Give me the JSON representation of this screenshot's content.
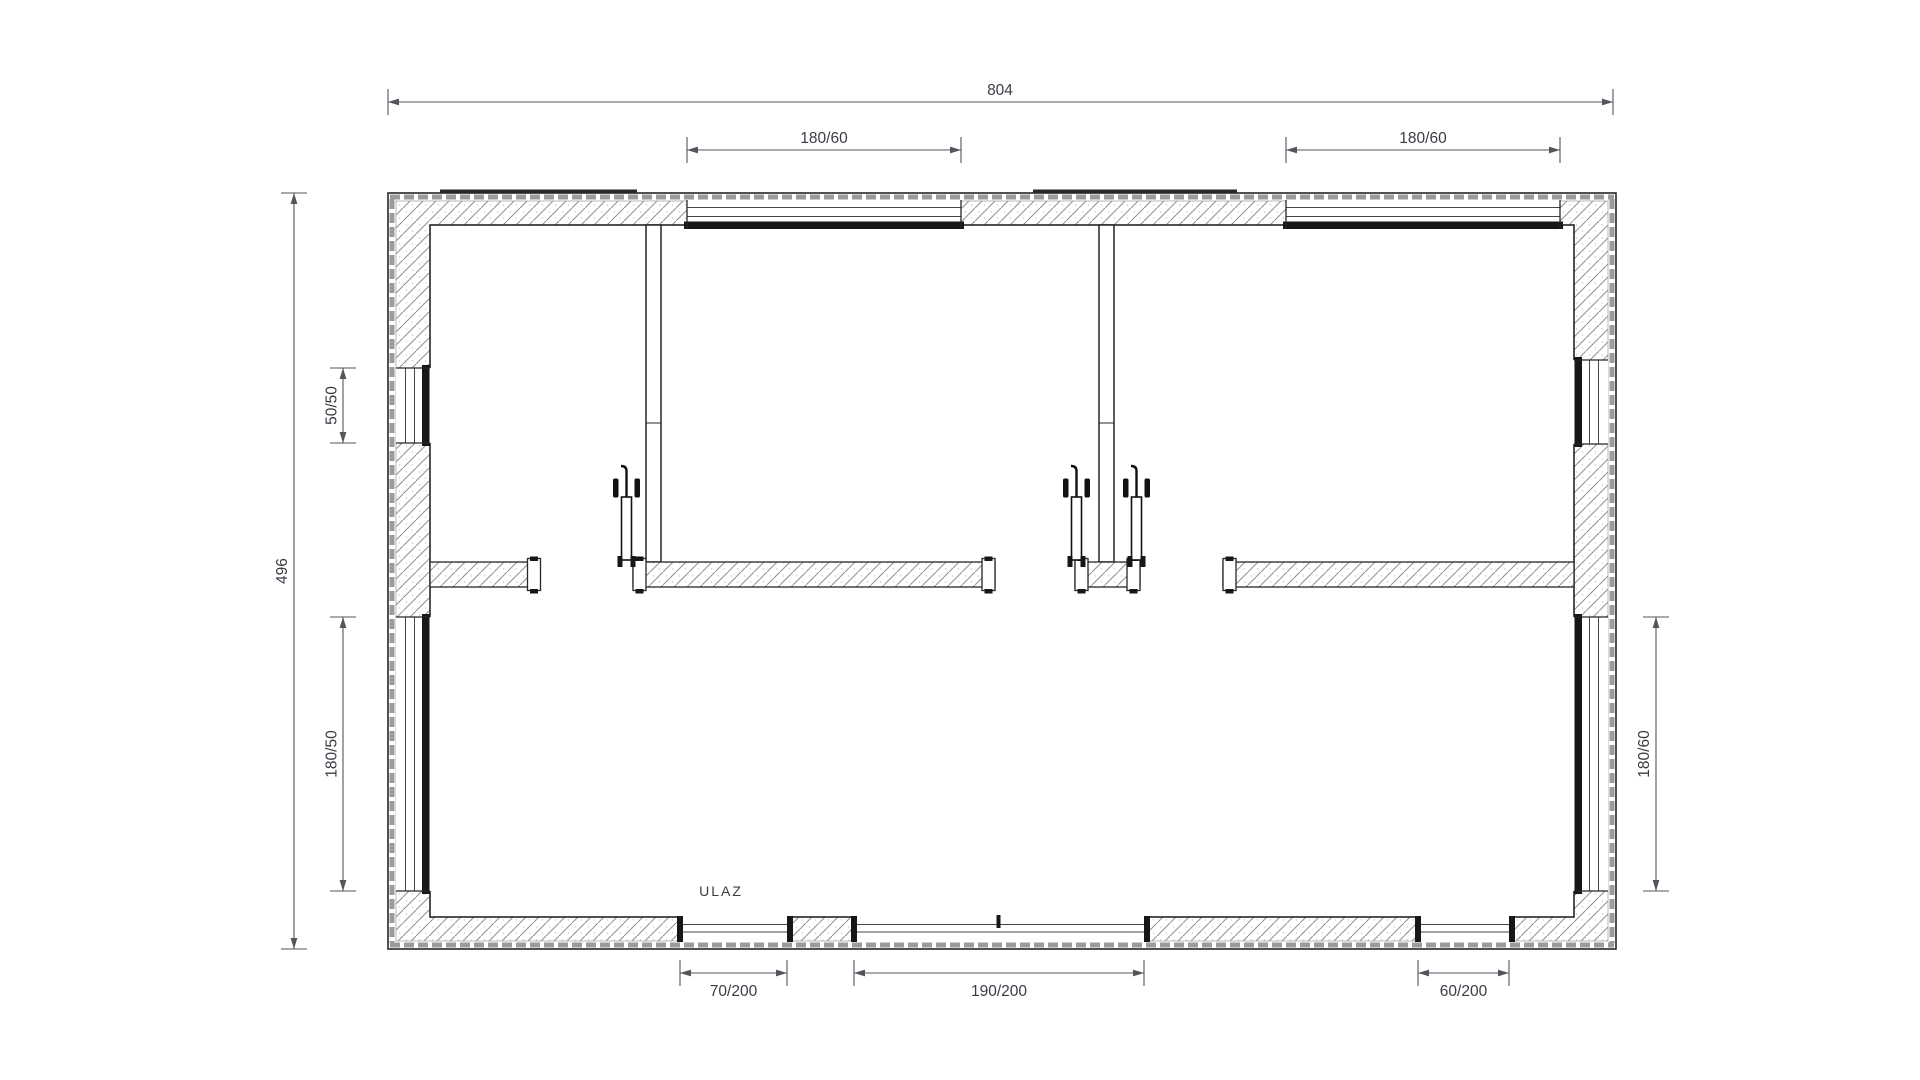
{
  "floor_plan": {
    "overall": {
      "width_label": "804",
      "height_label": "496"
    },
    "top_windows": {
      "left_label": "180/60",
      "right_label": "180/60"
    },
    "left_wall": {
      "small_window_label": "50/50",
      "large_window_label": "180/50"
    },
    "right_wall": {
      "window_label": "180/60"
    },
    "bottom_openings": {
      "entrance_door_label": "70/200",
      "main_door_label": "190/200",
      "small_door_label": "60/200"
    },
    "entrance_label": "ULAZ",
    "colors": {
      "line": "#26262b",
      "dimension": "#54545c",
      "text": "#3b3b44",
      "sill": "#17171a",
      "background": "#ffffff"
    }
  }
}
